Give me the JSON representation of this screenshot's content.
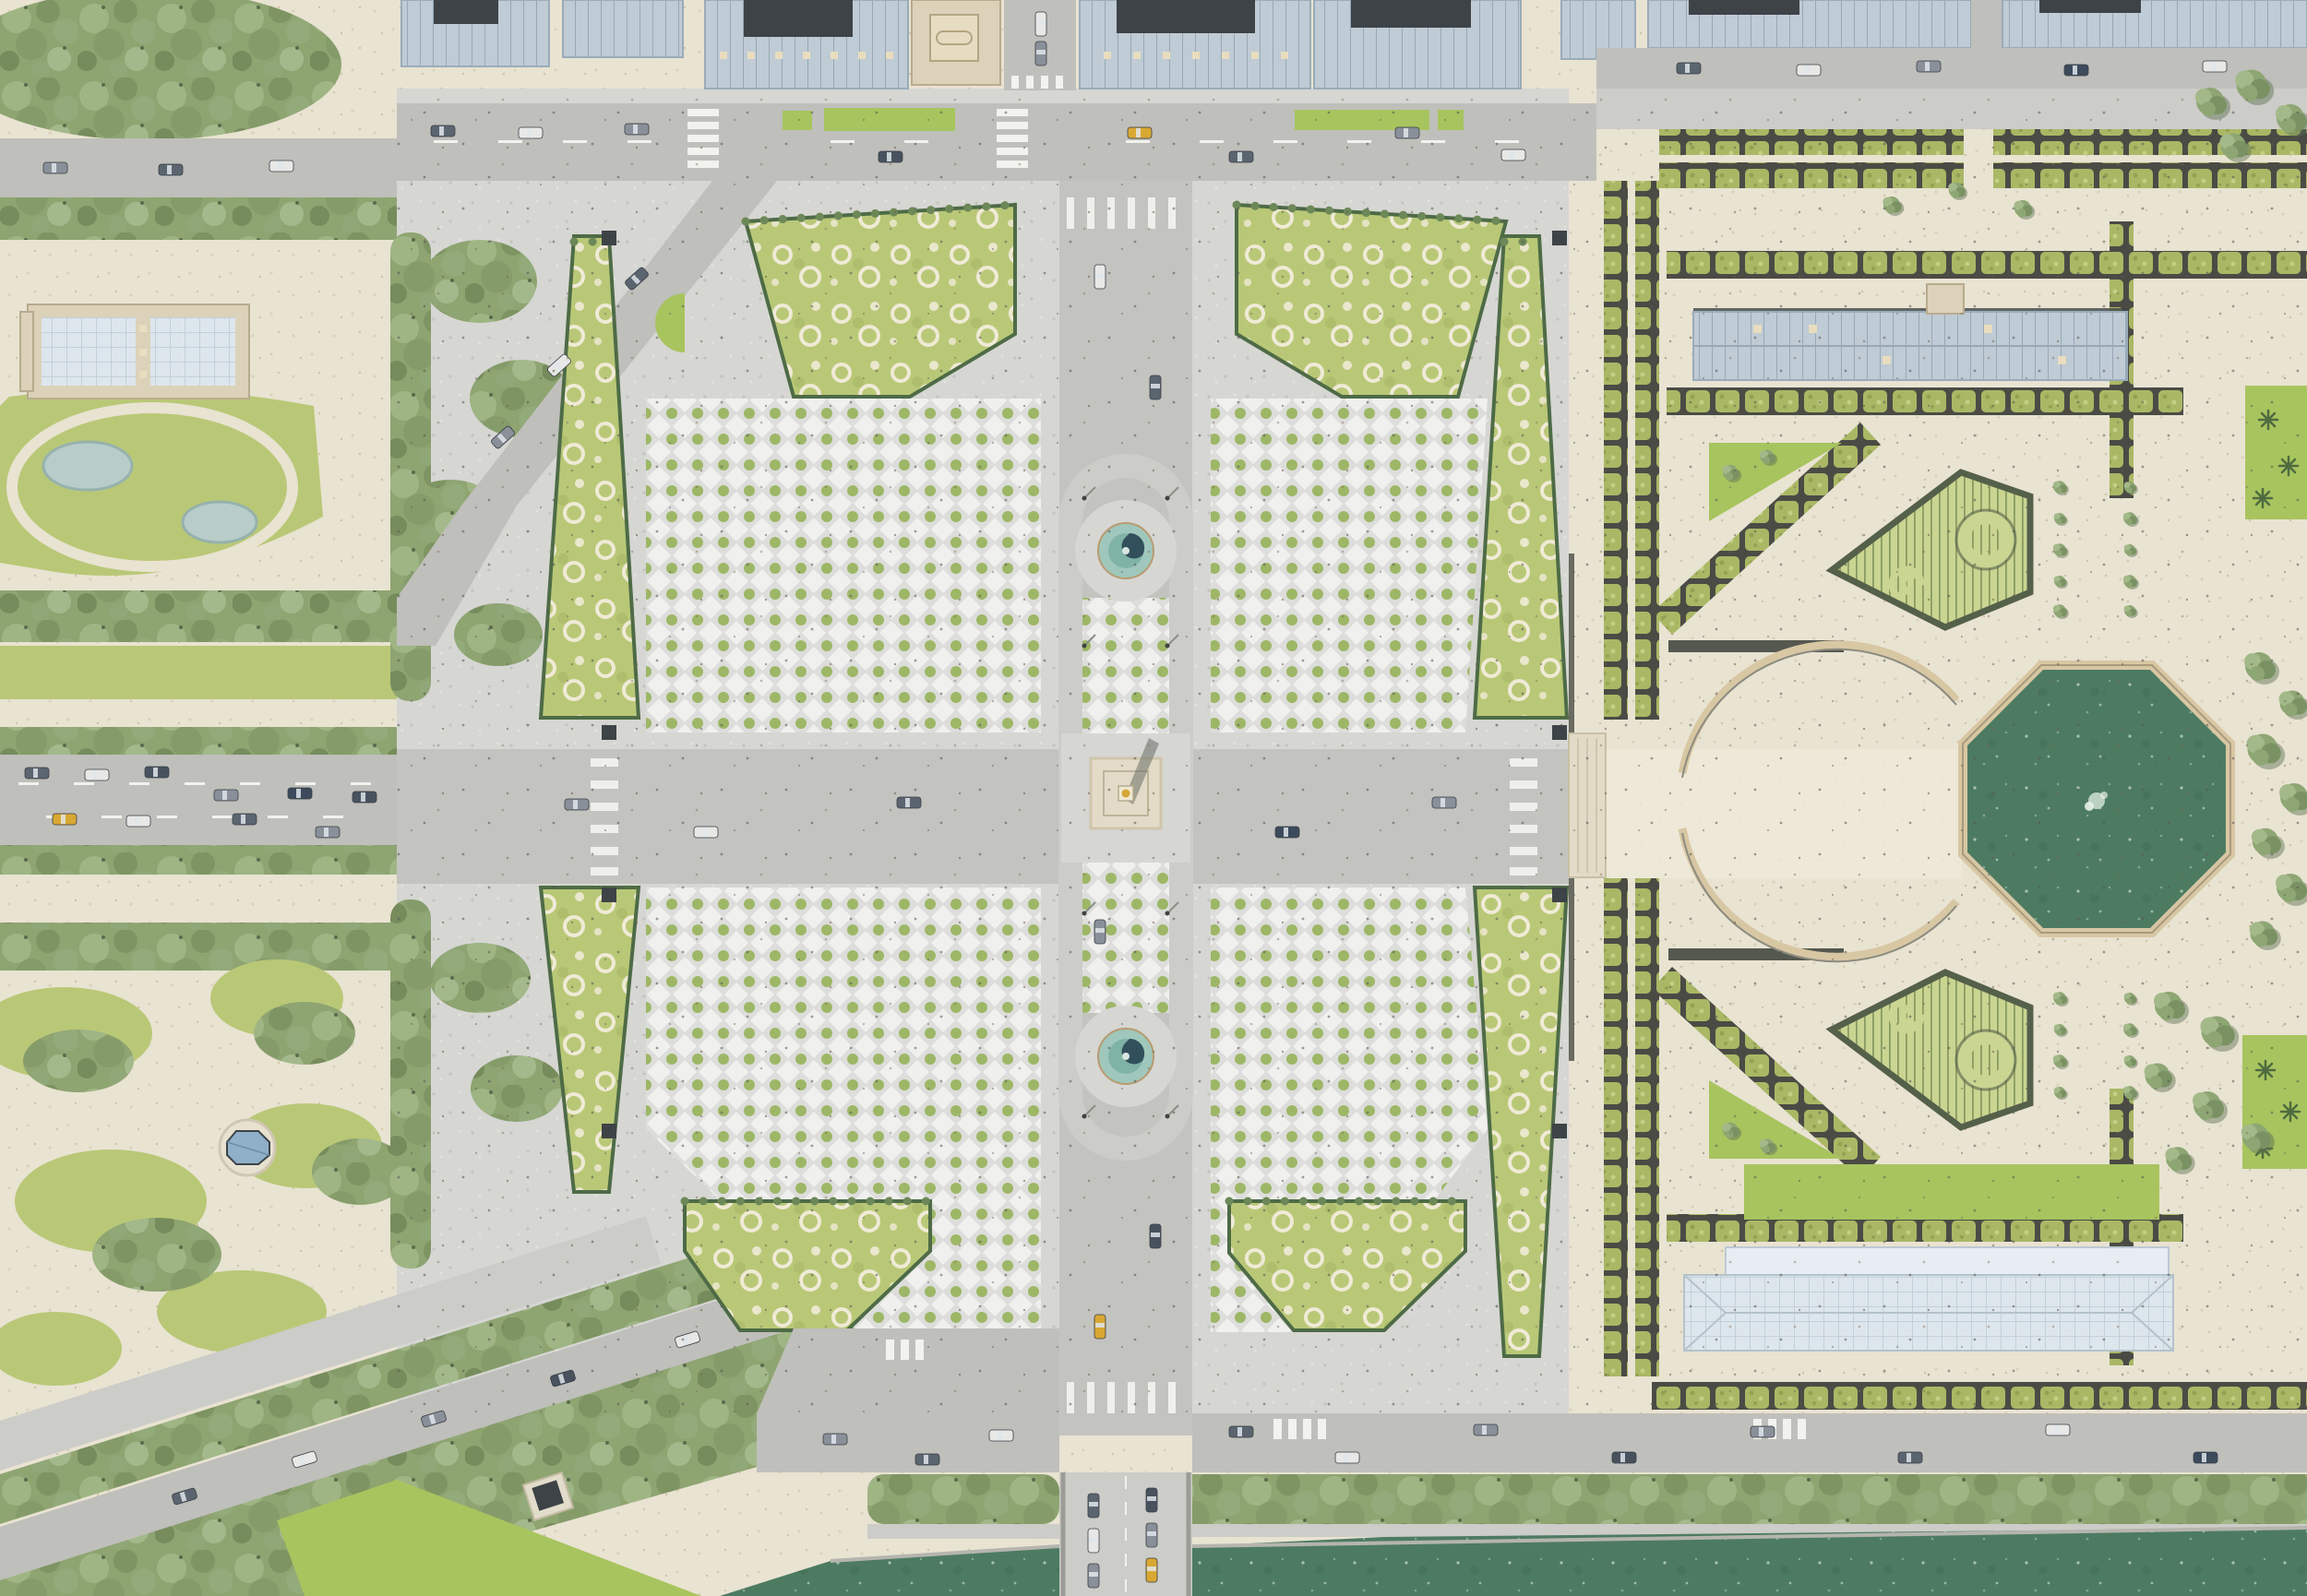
{
  "meta": {
    "title": "Aerial architectural plan rendering — Place de la Concorde and Tuileries Garden, Paris",
    "view": "top-down site plan, no text labels visible"
  },
  "palette": {
    "paving": "#d6d6d3",
    "pavingDark": "#c3c3bf",
    "road": "#bfbfbb",
    "roadLight": "#ccccc8",
    "laneWhite": "#f2f2ee",
    "sand": "#e9e3d2",
    "sandPath": "#efe9da",
    "lawn": "#b9c877",
    "lawnBright": "#a8c45e",
    "lawnPale": "#c9d591",
    "hedge": "#aab865",
    "hedgeDark": "#55604a",
    "soil": "#4b4b45",
    "tree1": "#a3b989",
    "tree2": "#8da673",
    "tree3": "#7a9263",
    "treeShadow": "#5c6e50",
    "water": "#4d7b62",
    "basin": "#3d7a4d",
    "basinRim": "#d8c7a3",
    "fountain": "#9fc7bb",
    "fountainDeep": "#7fb3a6",
    "fountainDark": "#32505c",
    "roofBlue": "#bfcbd5",
    "roofLine": "#97a9b6",
    "roofDark": "#3e4347",
    "wallBeige": "#dcd2ba",
    "glass": "#dde6ec",
    "skylight": "#e9ddbe",
    "obeliskGold": "#d4a636",
    "stone": "#e3dbc8",
    "speck": "#55554f"
  },
  "landmarks": {
    "scene": "Place de la Concorde and Tuileries Garden — aerial plan",
    "plaza": "Place de la Concorde paved square",
    "obelisk": "Luxor Obelisk with gilded pyramidion and cast shadow",
    "north_fountain": "Fountain of the Rivers (north basin)",
    "south_fountain": "Maritime Fountain (south basin)",
    "median": "Central median ring around obelisk and fountains",
    "parterre_nw": "North-west paved parterre with planted dots",
    "parterre_ne": "North-east paved parterre with planted dots",
    "parterre_sw": "South-west paved parterre with planted dots",
    "parterre_se": "South-east paved parterre with planted dots",
    "lawns": "Lawn parterres with white flower beds and hedge borders",
    "top_buildings": "Hôtel de Crillon and Hôtel de la Marine blocks",
    "beige_court_building": "Courtyard building between the twin palaces",
    "rue_royale": "Rue Royale opening between the palaces",
    "rivoli": "Rue de Rivoli arcade buildings",
    "top_road": "Northern roadway with planting strips",
    "champs_gardens": "Champs-Élysées gardens with lawns, ponds and groves",
    "garden_building": "Garden pavilion building with glazed roofs",
    "ponds": "Ornamental garden ponds",
    "small_pavilion": "Octagonal garden kiosk with blue roof",
    "avenue": "Avenue des Champs-Élysées with traffic lanes",
    "cours_la_reine": "Cours la Reine diagonal tree-lined roads",
    "tuileries": "Tuileries Garden gravel terraces",
    "terrace_hedges": "Rows of clipped pleached trees on dark soil beds",
    "jeu_de_paume": "Jeu de Paume building",
    "orangerie": "Orangerie building with glass roof",
    "horseshoe": "Horseshoe ramp walls",
    "octagonal_basin": "Grand octagonal basin with fountain jet",
    "triangle_parterre_n": "Triangular boxwood parterre with circle and spiral (north)",
    "triangle_parterre_s": "Triangular boxwood parterre with circle and spiral (south)",
    "bosquets": "Tree bosquets",
    "quay": "Quai des Tuileries with tree rows",
    "bridge": "Pont de la Concorde with queued cars",
    "river": "Seine river",
    "vehicles": "Cars on the roadways",
    "guerites": "Corner sentry pavilions of the square",
    "lamps": "Lamp posts with shadows"
  }
}
